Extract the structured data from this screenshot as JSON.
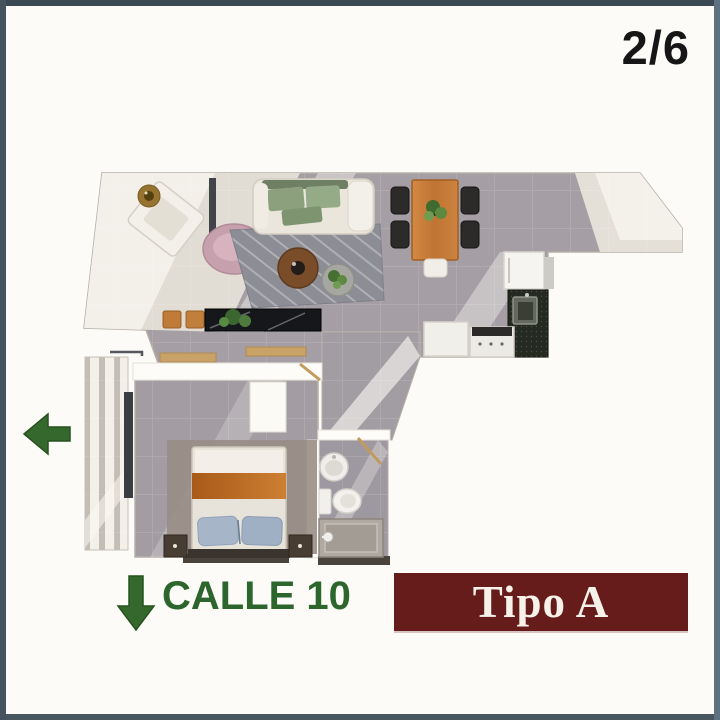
{
  "page": {
    "indicator": "2/6",
    "street": {
      "label": "CALLE 10",
      "arrow_direction": "down"
    },
    "side_arrow_direction": "left",
    "unit_type": {
      "label": "Tipo A"
    }
  },
  "colors": {
    "frame_border": "#404e5a",
    "background": "#fcfbf7",
    "banner_background": "#671c1c",
    "banner_text": "#f6f2ea",
    "street_green": "#2d662d",
    "arrow_green": "#35682d",
    "page_indicator_text": "#161616",
    "floor_gray": "#a59fa5",
    "floor_light": "#e9e4da",
    "wood_accent": "#c8803c",
    "bed_band_orange": "#b8661f",
    "counter_granite": "#252a21"
  },
  "floor_plan": {
    "rooms": [
      "living-lounge",
      "dining-area",
      "kitchen",
      "hallway",
      "bedroom",
      "bathroom",
      "balcony"
    ],
    "furniture": [
      "armchair",
      "side-table",
      "pink-lounge-chair",
      "sofa",
      "area-rug",
      "coffee-table-wood",
      "coffee-table-concrete",
      "stools",
      "marble-console-with-plant",
      "dining-table-with-plant",
      "dining-chairs",
      "fridge",
      "granite-counter-with-sink",
      "stove",
      "kitchen-cabinet",
      "double-bed",
      "nightstands",
      "closet-shelves",
      "round-washbasin",
      "toilet",
      "shower",
      "balcony-deck-slats"
    ]
  }
}
